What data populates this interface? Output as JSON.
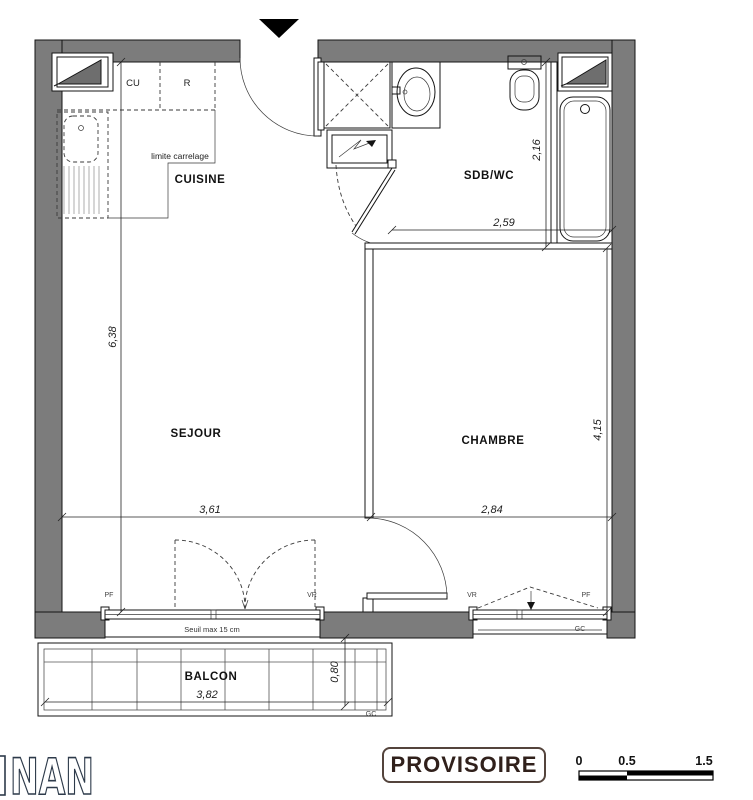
{
  "plan": {
    "rooms": {
      "cuisine": "CUISINE",
      "sejour": "SEJOUR",
      "chambre": "CHAMBRE",
      "sdb_wc": "SDB/WC",
      "balcon": "BALCON"
    },
    "kitchen_labels": {
      "cu": "CU",
      "r": "R",
      "limite_carrelage": "limite carrelage"
    },
    "dims": {
      "sejour_height": "6,38",
      "sejour_width": "3,61",
      "chambre_width": "2,84",
      "chambre_height": "4,15",
      "sdb_width": "2,59",
      "sdb_height": "2,16",
      "balcon_depth": "0,80",
      "balcon_width": "3,82"
    },
    "labels": {
      "seuil": "Seuil max 15 cm",
      "sejour_pf": "PF",
      "sejour_vr": "VR",
      "chambre_vr": "VR",
      "chambre_pf": "PF",
      "chambre_gc": "GC",
      "balcon_gc": "GC"
    }
  },
  "footer": {
    "logo_text": "NAN",
    "stamp": "PROVISOIRE",
    "scale": {
      "t0": "0",
      "t1": "0.5",
      "t2": "1.5"
    }
  },
  "colors": {
    "wall": "#7c7c7c",
    "stamp_border": "#54443c",
    "stamp_text": "#30201b",
    "logo_outline": "#2d3a4a"
  }
}
